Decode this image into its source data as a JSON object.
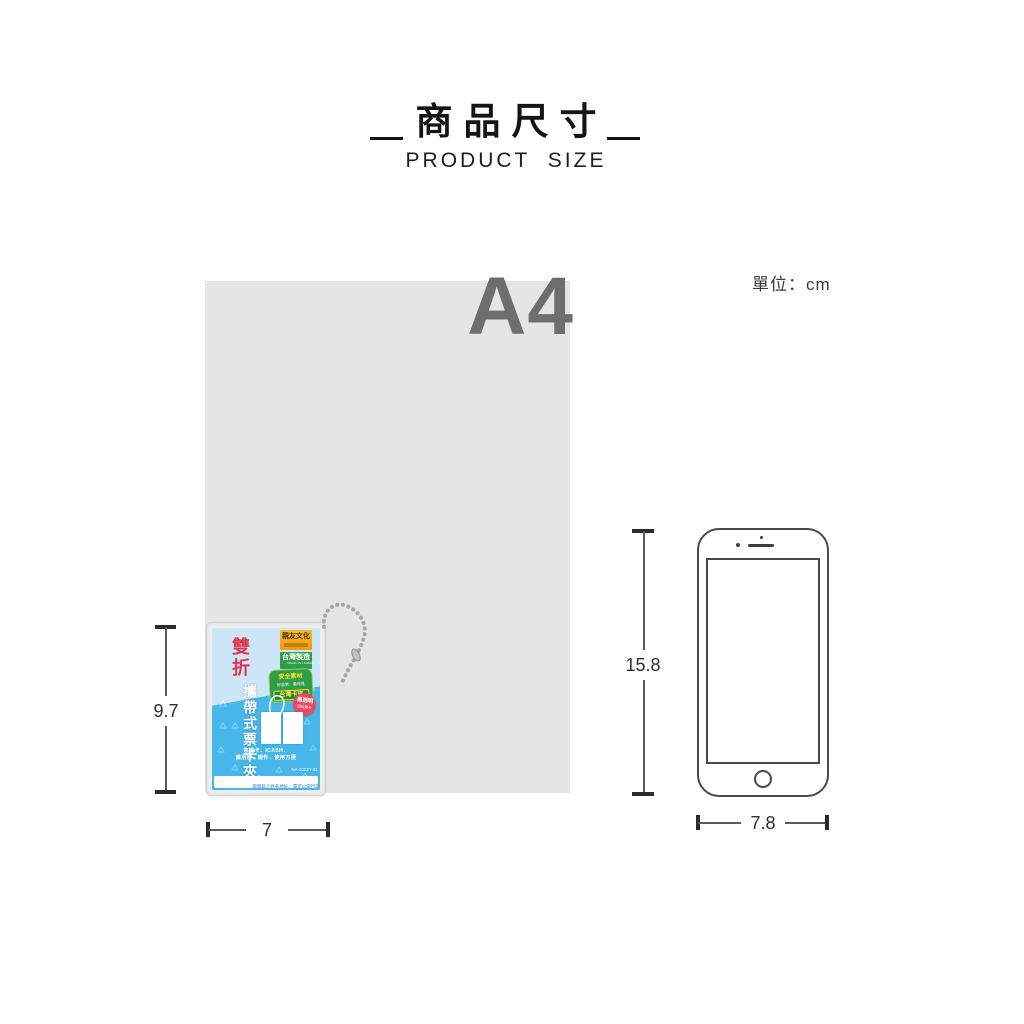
{
  "header": {
    "title": "商品尺寸",
    "subtitle": "PRODUCT SIZE"
  },
  "unit": {
    "label": "單位：cm"
  },
  "paper": {
    "label": "A4"
  },
  "card": {
    "fold_label": "雙折",
    "product_title": "攜帶式票卡夾",
    "brand_tag": "親友文化",
    "made_tag": "台灣製造",
    "made_tag_sub": "MADE IN TAIWAN",
    "seal_line1": "安全素材",
    "seal_line2": "好品質．看得見",
    "seal_line3": "台灣卡夾",
    "red_badge_line1": "高透明",
    "red_badge_line2": "回料薄卡",
    "desc_line1": "悠遊卡．ICASH．",
    "desc_line2": "識別證．證件．使用方便",
    "model_no": "NA-2002Y-01",
    "footer_note": "兩面寫上姓名地址．還可以當行李吊牌"
  },
  "dimensions": {
    "card_height": "9.7",
    "card_width": "7",
    "phone_height": "15.8",
    "phone_width": "7.8"
  },
  "colors": {
    "paper_gray": "#e5e5e5",
    "paper_label_gray": "#6e6e6e",
    "card_blue": "#47b7e9",
    "card_light_blue": "#cde6f7",
    "fold_red": "#e0344e",
    "tag_orange": "#f6a81c",
    "tag_green": "#2f9e44",
    "badge_red": "#e84a62",
    "dimension_line": "#4a4a4a"
  }
}
